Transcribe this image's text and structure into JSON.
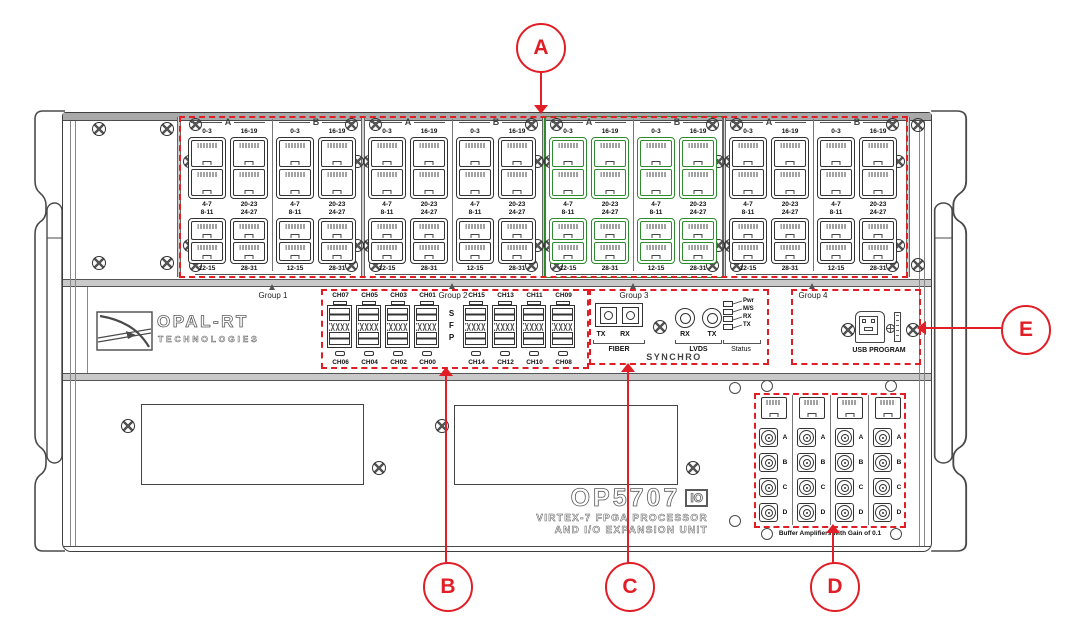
{
  "product": {
    "model": "OP5707",
    "io_badge": "IO",
    "line1": "VIRTEX-7 FPGA PROCESSOR",
    "line2": "AND I/O EXPANSION UNIT"
  },
  "brand": {
    "name": "OPAL-RT",
    "subtitle": "TECHNOLOGIES"
  },
  "groups": {
    "group1": "Group 1",
    "group2": "Group 2",
    "group3": "Group 3",
    "group4": "Group 4"
  },
  "top_panel": {
    "slot_count": 4,
    "highlighted_slot_index": 2,
    "section_letters": [
      "A",
      "B"
    ],
    "column_sets": [
      {
        "top": "0-3",
        "upper_mid": "4-7",
        "lower_mid": "8-11",
        "bottom": "12-15"
      },
      {
        "top": "16-19",
        "upper_mid": "20-23",
        "lower_mid": "24-27",
        "bottom": "28-31"
      }
    ]
  },
  "sfp": {
    "vertical_label": "SFP",
    "block1": {
      "top_labels": [
        "CH07",
        "CH05",
        "CH03",
        "CH01"
      ],
      "bottom_labels": [
        "CH06",
        "CH04",
        "CH02",
        "CH00"
      ]
    },
    "block2": {
      "top_labels": [
        "CH15",
        "CH13",
        "CH11",
        "CH09"
      ],
      "bottom_labels": [
        "CH14",
        "CH12",
        "CH10",
        "CH08"
      ]
    }
  },
  "synchro": {
    "title": "SYNCHRO",
    "fiber": {
      "label": "FIBER",
      "ports": [
        "TX",
        "RX"
      ]
    },
    "lvds": {
      "label": "LVDS",
      "ports": [
        "RX",
        "TX"
      ]
    },
    "status": {
      "label": "Status",
      "leds": [
        "Pwr",
        "M/S",
        "RX",
        "TX"
      ]
    }
  },
  "usb": {
    "label": "USB PROGRAM"
  },
  "buffer_panel": {
    "caption": "Buffer Amplifiers with Gain of 0.1",
    "column_count": 4,
    "bnc_row_labels": [
      "A",
      "B",
      "C",
      "D"
    ]
  },
  "callouts": [
    {
      "letter": "A"
    },
    {
      "letter": "B"
    },
    {
      "letter": "C"
    },
    {
      "letter": "D"
    },
    {
      "letter": "E"
    }
  ],
  "colors": {
    "callout_red": "#e11d26",
    "highlight_green": "#2e8b2e"
  }
}
